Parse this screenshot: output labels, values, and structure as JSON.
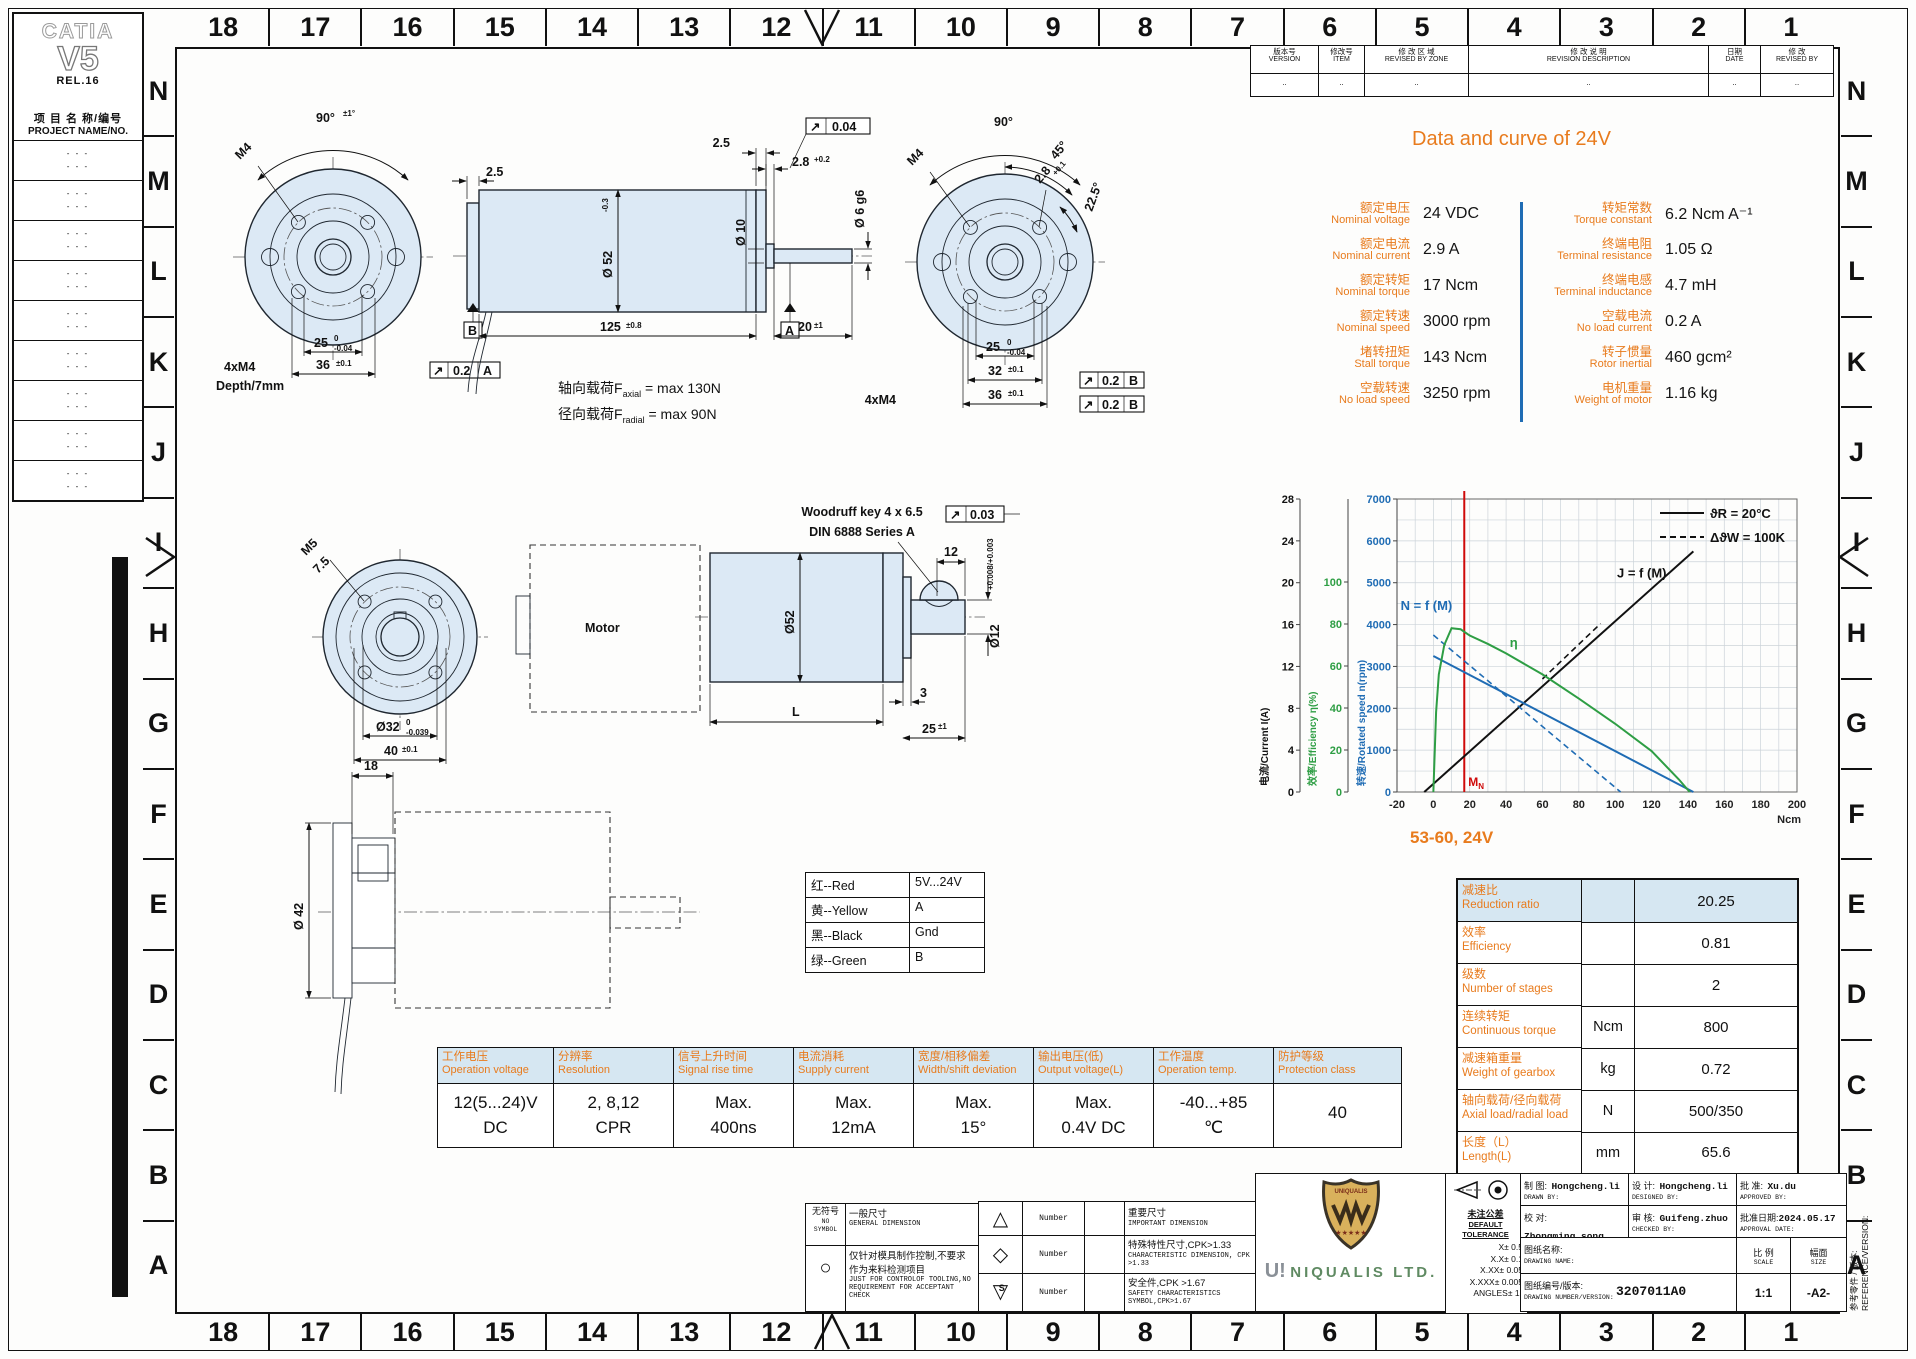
{
  "catia": {
    "l1": "CATIA",
    "l2": "V5",
    "l3": "REL.16"
  },
  "project": {
    "cn": "项 目 名 称/编号",
    "en": "PROJECT NAME/NO.",
    "rows": [
      "- - -\n- - -",
      "- - -\n- - -",
      "- - -\n- - -",
      "- - -\n- - -",
      "- - -\n- - -",
      "- - -\n- - -",
      "- - -\n- - -",
      "- - -\n- - -",
      "- - -\n- - -"
    ]
  },
  "grid": {
    "cols": [
      "18",
      "17",
      "16",
      "15",
      "14",
      "13",
      "12",
      "11",
      "10",
      "9",
      "8",
      "7",
      "6",
      "5",
      "4",
      "3",
      "2",
      "1"
    ],
    "rows": [
      "N",
      "M",
      "L",
      "K",
      "J",
      "I",
      "H",
      "G",
      "F",
      "E",
      "D",
      "C",
      "B",
      "A"
    ]
  },
  "revision": {
    "h": [
      {
        "cn": "版本号",
        "en": "VERSION"
      },
      {
        "cn": "修改号",
        "en": "ITEM"
      },
      {
        "cn": "修 改 区 域",
        "en": "REVISED BY ZONE"
      },
      {
        "cn": "修 改 说 明",
        "en": "REVISION DESCRIPTION"
      },
      {
        "cn": "日期",
        "en": "DATE"
      },
      {
        "cn": "修  改",
        "en": "REVISED BY"
      }
    ],
    "v": [
      "..",
      "..",
      "..",
      "..",
      "..",
      ".."
    ]
  },
  "spec": {
    "title": "Data and curve of 24V",
    "left": [
      {
        "cn": "额定电压",
        "en": "Nominal voltage",
        "val": "24 VDC"
      },
      {
        "cn": "额定电流",
        "en": "Nominal current",
        "val": "2.9 A"
      },
      {
        "cn": "额定转矩",
        "en": "Nominal torque",
        "val": "17 Ncm"
      },
      {
        "cn": "额定转速",
        "en": "Nominal speed",
        "val": "3000 rpm"
      },
      {
        "cn": "堵转扭矩",
        "en": "Stall torque",
        "val": "143 Ncm"
      },
      {
        "cn": "空载转速",
        "en": "No load speed",
        "val": "3250 rpm"
      }
    ],
    "right": [
      {
        "cn": "转矩常数",
        "en": "Torque constant",
        "val": "6.2 Ncm A⁻¹"
      },
      {
        "cn": "终端电阻",
        "en": "Terminal resistance",
        "val": "1.05 Ω"
      },
      {
        "cn": "终端电感",
        "en": "Terminal inductance",
        "val": "4.7 mH"
      },
      {
        "cn": "空载电流",
        "en": "No load current",
        "val": "0.2 A"
      },
      {
        "cn": "转子惯量",
        "en": "Rotor inertial",
        "val": "460 gcm²"
      },
      {
        "cn": "电机重量",
        "en": "Weight of motor",
        "val": "1.16 kg"
      }
    ]
  },
  "chart_data": {
    "type": "line",
    "footer": "53-60, 24V",
    "x_axis": {
      "label": "Ncm",
      "min": -20,
      "max": 200,
      "tick": 20
    },
    "y_axes": [
      {
        "label": "电流/Current I(A)",
        "ticks": [
          0,
          4,
          8,
          12,
          16,
          20,
          24,
          28
        ],
        "color": "#111111"
      },
      {
        "label": "效率/Efficiency η(%)",
        "ticks": [
          0,
          20,
          40,
          60,
          80,
          100
        ],
        "color": "#2e9e44"
      },
      {
        "label": "转速/Rotated speed n(rpm)",
        "ticks": [
          0,
          1000,
          2000,
          3000,
          4000,
          5000,
          6000,
          7000
        ],
        "color": "#1f6cb4"
      }
    ],
    "legend": [
      {
        "label": "ϑR = 20°C",
        "style": "solid"
      },
      {
        "label": "ΔϑW = 100K",
        "style": "dashed"
      }
    ],
    "marker": {
      "name": "MN",
      "x": 17,
      "color": "#cf0a0a"
    },
    "series": [
      {
        "name": "J = f (M)",
        "axis": "current",
        "style": "solid",
        "color": "#111111",
        "width": 2,
        "points": [
          [
            -5,
            0
          ],
          [
            143,
            23
          ]
        ],
        "label_at": [
          101,
          20.5
        ]
      },
      {
        "name": "",
        "axis": "current",
        "style": "dashed",
        "color": "#111111",
        "width": 1.6,
        "points": [
          [
            60,
            10.8
          ],
          [
            92,
            16.1
          ]
        ]
      },
      {
        "name": "N = f (M)",
        "axis": "speed",
        "style": "solid",
        "color": "#1f6cb4",
        "width": 2,
        "points": [
          [
            0,
            3250
          ],
          [
            143,
            0
          ]
        ],
        "label_at": [
          -18,
          4350
        ]
      },
      {
        "name": "",
        "axis": "speed",
        "style": "dashed",
        "color": "#1f6cb4",
        "width": 1.6,
        "points": [
          [
            0,
            3750
          ],
          [
            103,
            0
          ]
        ]
      },
      {
        "name": "η",
        "axis": "efficiency",
        "style": "solid",
        "color": "#2e9e44",
        "width": 2,
        "points": [
          [
            0,
            0
          ],
          [
            1.5,
            38
          ],
          [
            3,
            56
          ],
          [
            6,
            70
          ],
          [
            10,
            78
          ],
          [
            15,
            77.5
          ],
          [
            20,
            74.5
          ],
          [
            30,
            70.5
          ],
          [
            40,
            66
          ],
          [
            60,
            56
          ],
          [
            80,
            44.5
          ],
          [
            100,
            32.5
          ],
          [
            120,
            19.5
          ],
          [
            135,
            6
          ],
          [
            141,
            0
          ]
        ],
        "label_at": [
          42,
          69
        ]
      }
    ]
  },
  "views": {
    "ff": {
      "angle": "90°",
      "angle_tol": "±1°",
      "m4": "M4",
      "d25": "25",
      "d25t": "0",
      "d25b": "-0.04",
      "d36": "36",
      "d36t": "±0.1",
      "bolt": "4xM4",
      "depth": "Depth/7mm",
      "f_sym": "↗",
      "f_val": "0.2",
      "f_dat": "A"
    },
    "ms": {
      "w25l": "2.5",
      "w25r": "2.5",
      "w28": "2.8",
      "w28t": "+0.2",
      "f_sym": "↗",
      "f_val": "0.04",
      "d6": "Ø 6 g6",
      "d10": "Ø 10",
      "d52": "Ø 52",
      "d52t": "-0.3",
      "len": "125",
      "lent": "±0.8",
      "l20": "20",
      "l20t": "±1",
      "datA": "A",
      "datB": "B"
    },
    "loads": {
      "p1": "轴向载荷F",
      "s1": "axial",
      "r1": " = max 130N",
      "p2": "径向载荷F",
      "s2": "radial",
      "r2": " = max 90N"
    },
    "fr": {
      "angle": "90°",
      "a45": "45°",
      "a225": "22.5°",
      "m4": "M4",
      "w28": "2.8",
      "w28t": "+0.1",
      "d25": "25",
      "d25t": "0",
      "d25b": "-0.04",
      "d32": "32",
      "d32t": "±0.1",
      "d36": "36",
      "d36t": "±0.1",
      "bolt": "4xM4",
      "f_sym": "↗",
      "f_val": "0.2",
      "f_dat": "B"
    },
    "gf": {
      "m5": "M5",
      "depth": "7.5",
      "d32": "Ø32",
      "d32t": "0",
      "d32b": "-0.039",
      "d40": "40",
      "d40t": "±0.1"
    },
    "gs": {
      "key1": "Woodruff key 4 x 6.5",
      "key2": "DIN 6888 Series A",
      "f_sym": "↗",
      "f_val": "0.03",
      "d12": "12",
      "d52": "Ø52",
      "L": "L",
      "d3": "3",
      "d25": "25",
      "d25t": "±1",
      "dia12": "Ø12",
      "dia12t": "+0.008/+0.003",
      "motor": "Motor"
    },
    "ev": {
      "d18": "18",
      "d42": "Ø 42"
    }
  },
  "wire": [
    [
      "红--Red",
      "5V...24V"
    ],
    [
      "黄--Yellow",
      "A"
    ],
    [
      "黑--Black",
      "Gnd"
    ],
    [
      "绿--Green",
      "B"
    ]
  ],
  "enc": {
    "cols": [
      {
        "cn": "工作电压",
        "en": "Operation voltage",
        "l1": "12(5...24)V",
        "l2": "DC"
      },
      {
        "cn": "分辨率",
        "en": "Resolution",
        "l1": "2, 8,12",
        "l2": "CPR"
      },
      {
        "cn": "信号上升时间",
        "en": "Signal rise time",
        "l1": "Max.",
        "l2": "400ns"
      },
      {
        "cn": "电流消耗",
        "en": "Supply current",
        "l1": "Max.",
        "l2": "12mA"
      },
      {
        "cn": "宽度/相移偏差",
        "en": "Width/shift deviation",
        "l1": "Max.",
        "l2": "15°"
      },
      {
        "cn": "输出电压(低)",
        "en": "Output voltage(L)",
        "l1": "Max.",
        "l2": "0.4V DC"
      },
      {
        "cn": "工作温度",
        "en": "Operation temp.",
        "l1": "-40...+85",
        "l2": "℃"
      },
      {
        "cn": "防护等级",
        "en": "Protection class",
        "l1": "40",
        "l2": ""
      }
    ]
  },
  "gearbox": {
    "rows": [
      {
        "cn": "减速比",
        "en": "Reduction ratio",
        "unit": "",
        "val": "20.25"
      },
      {
        "cn": "效率",
        "en": "Efficiency",
        "unit": "",
        "val": "0.81"
      },
      {
        "cn": "级数",
        "en": "Number of stages",
        "unit": "",
        "val": "2"
      },
      {
        "cn": "连续转矩",
        "en": "Continuous torque",
        "unit": "Ncm",
        "val": "800"
      },
      {
        "cn": "减速箱重量",
        "en": "Weight of gearbox",
        "unit": "kg",
        "val": "0.72"
      },
      {
        "cn": "轴向载荷/径向载荷",
        "en": "Axial load/radial load",
        "unit": "N",
        "val": "500/350"
      },
      {
        "cn": "长度（L）",
        "en": "Length(L)",
        "unit": "mm",
        "val": "65.6"
      }
    ]
  },
  "symbols": {
    "left": [
      {
        "sym": "无符号",
        "sym_en": "NO SYMBOL",
        "cn": "一般尺寸",
        "en": "GENERAL DIMENSION"
      },
      {
        "sym": "○",
        "cn": "仅针对模具制作控制,不要求\n作为来料检测项目",
        "en": "JUST FOR CONTROLOF TOOLING,NO\nREQUIREMENT FOR ACCEPTANT CHECK"
      }
    ],
    "right": [
      {
        "sym": "△",
        "num": "Number",
        "cn": "重要尺寸",
        "en": "IMPORTANT DIMENSION"
      },
      {
        "sym": "◇",
        "num": "Number",
        "cn": "特殊特性尺寸,CPK>1.33",
        "en": "CHARACTERISTIC DIMENSION, CPK >1.33"
      },
      {
        "sym": "▽",
        "sym_s": "S",
        "num": "Number",
        "cn": "安全件,CPK >1.67",
        "en": "SAFETY CHARACTERISTICS SYMBOL,CPK>1.67"
      }
    ]
  },
  "title_block": {
    "drawn": {
      "cn": "制  图:",
      "en": "DRAWN BY:",
      "val": "Hongcheng.li"
    },
    "designed": {
      "cn": "设  计:",
      "en": "DESIGNED BY:",
      "val": "Hongcheng.li"
    },
    "approved": {
      "cn": "批  准:",
      "en": "APPROVED BY:",
      "val": "Xu.du"
    },
    "collated": {
      "cn": "校  对:",
      "en": "COLLATED BY:",
      "val": "Zhongming.song"
    },
    "checked": {
      "cn": "审  核:",
      "en": "CHECKED BY:",
      "val": "Guifeng.zhuo"
    },
    "date": {
      "cn": "批准日期:",
      "en": "APPROVAL DATE:",
      "val": "2024.05.17"
    },
    "name": {
      "cn": "图纸名称:",
      "en": "DRAWING NAME:",
      "val": ""
    },
    "number": {
      "cn": "图纸编号/版本:",
      "en": "DRAWING NUMBER/VERSION:",
      "val": "3207011A0"
    },
    "scale": {
      "cn": "比 例",
      "en": "SCALE",
      "val": "1:1"
    },
    "size": {
      "cn": "幅面",
      "en": "SIZE",
      "val": "-A2-"
    },
    "tolerance": {
      "t1": "未注公差",
      "t2": "DEFAULT TOLERANCE",
      "lines": [
        "X± 0.5",
        "X.X± 0.1",
        "X.XX± 0.05",
        "X.XXX± 0.005",
        "ANGLES± 1°"
      ]
    },
    "reference": {
      "cn": "参考零件 / 版本:",
      "en": "REFERENCE/VERSION:"
    },
    "company": {
      "mark": "U!",
      "name": "NIQUALIS LTD.",
      "shield": "UNIQUALIS"
    }
  }
}
